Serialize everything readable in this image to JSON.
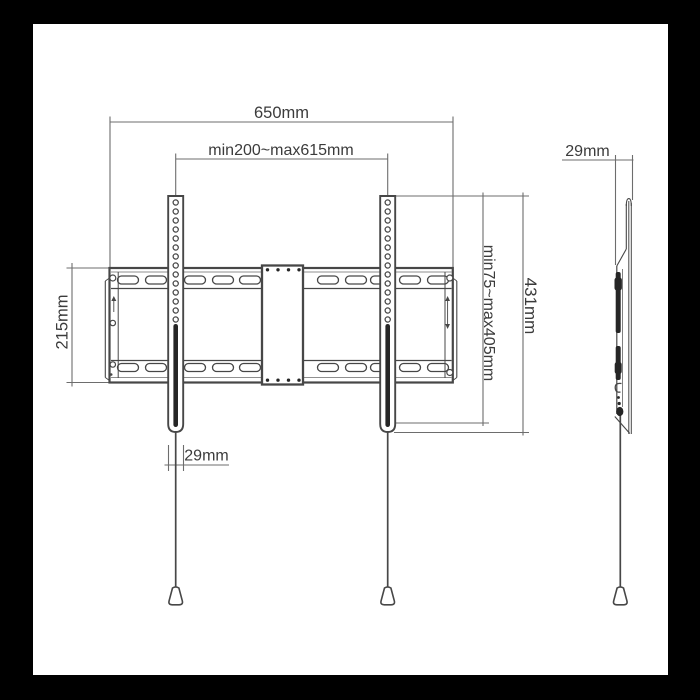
{
  "dimensions": {
    "front": {
      "total_width": "650mm",
      "hole_span_range": "min200~max615mm",
      "plate_height": "215mm",
      "vesa_height_range": "min75~max405mm",
      "bracket_height": "431mm",
      "bracket_width": "29mm"
    },
    "side": {
      "profile_depth": "29mm"
    }
  },
  "colors": {
    "background": "#ffffff",
    "frame": "#000000",
    "line": "#474747",
    "dim_line": "#6d6d6d",
    "text": "#3b3b3b",
    "dark_fill": "#262626"
  }
}
